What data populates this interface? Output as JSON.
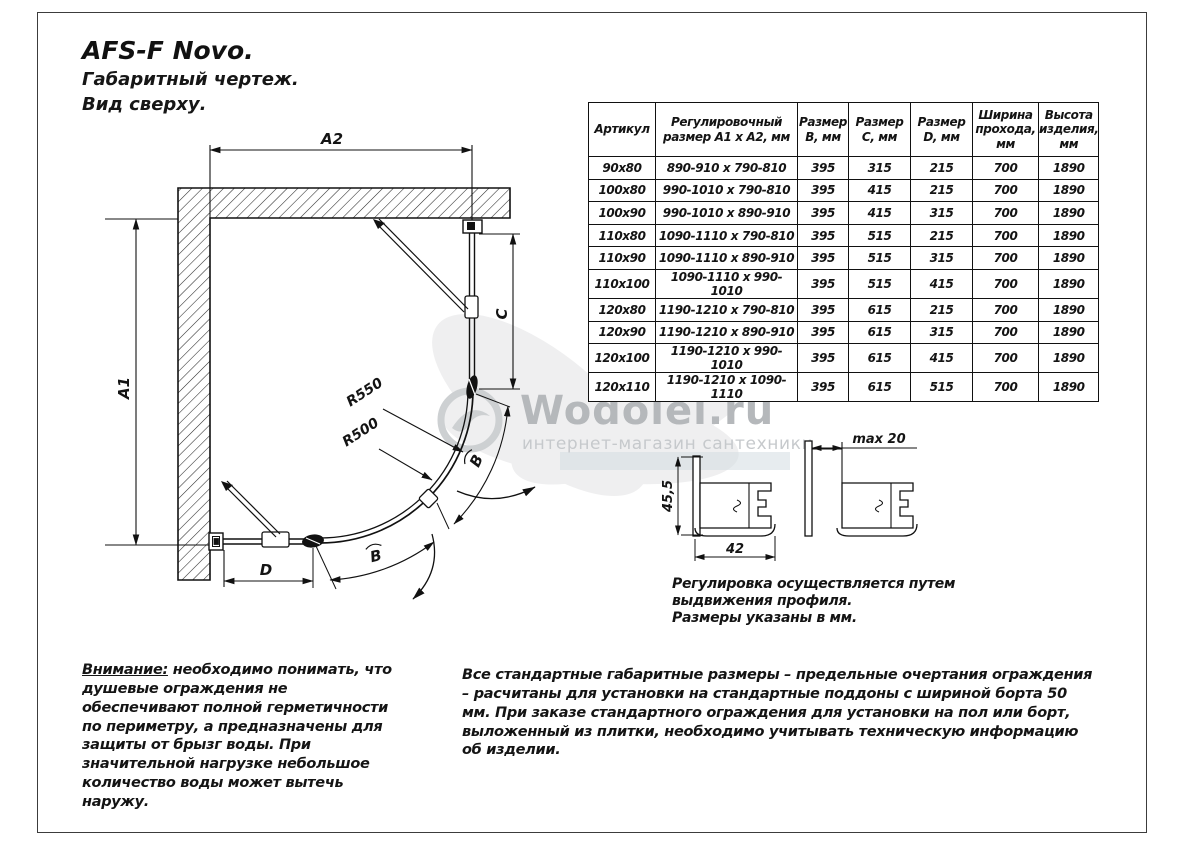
{
  "page": {
    "title": "AFS-F Novo.",
    "subtitle1": "Габаритный чертеж.",
    "subtitle2": "Вид сверху."
  },
  "drawing": {
    "labels": {
      "a1": "A1",
      "a2": "A2",
      "c": "C",
      "d": "D",
      "b_lower": "B",
      "b_upper": "B",
      "r_outer": "R550",
      "r_inner": "R500"
    }
  },
  "profiles": {
    "height_dim": "45,5",
    "width_dim": "42",
    "extension_dim": "max 20",
    "note_par1": "Регулировка осуществляется путем выдвижения профиля.",
    "note_par2": "Размеры указаны в мм."
  },
  "table": {
    "headers": [
      "Артикул",
      "Регулировочный\nразмер A1 х A2, мм",
      "Размер\nB, мм",
      "Размер\nC, мм",
      "Размер\nD, мм",
      "Ширина\nпрохода,\nмм",
      "Высота\nизделия,\nмм"
    ],
    "rows": [
      [
        "90x80",
        "890-910 х 790-810",
        "395",
        "315",
        "215",
        "700",
        "1890"
      ],
      [
        "100x80",
        "990-1010 х 790-810",
        "395",
        "415",
        "215",
        "700",
        "1890"
      ],
      [
        "100x90",
        "990-1010 х 890-910",
        "395",
        "415",
        "315",
        "700",
        "1890"
      ],
      [
        "110x80",
        "1090-1110 х 790-810",
        "395",
        "515",
        "215",
        "700",
        "1890"
      ],
      [
        "110x90",
        "1090-1110 х 890-910",
        "395",
        "515",
        "315",
        "700",
        "1890"
      ],
      [
        "110x100",
        "1090-1110 х 990-1010",
        "395",
        "515",
        "415",
        "700",
        "1890"
      ],
      [
        "120x80",
        "1190-1210 х 790-810",
        "395",
        "615",
        "215",
        "700",
        "1890"
      ],
      [
        "120x90",
        "1190-1210 х 890-910",
        "395",
        "615",
        "315",
        "700",
        "1890"
      ],
      [
        "120x100",
        "1190-1210 х 990-1010",
        "395",
        "615",
        "415",
        "700",
        "1890"
      ],
      [
        "120x110",
        "1190-1210 х 1090-1110",
        "395",
        "615",
        "515",
        "700",
        "1890"
      ]
    ]
  },
  "watermark": {
    "brand": "Wodolei.ru",
    "tagline": "интернет-магазин сантехники",
    "brand_color": "#b5b8bb",
    "tagline_color": "#c6c9cc"
  },
  "warning": {
    "label": "Внимание:",
    "text": " необходимо понимать, что душевые ограждения не обеспечивают полной герметичности по периметру, а предназначены для защиты от брызг воды. При значительной нагрузке небольшое количество воды может вытечь наружу."
  },
  "footnote": "Все стандартные габаритные размеры – предельные очертания ограждения – расчитаны для установки на стандартные поддоны с шириной борта 50 мм. При заказе стандартного ограждения для установки на пол или борт, выложенный из плитки, необходимо учитывать техническую информацию об изделии."
}
